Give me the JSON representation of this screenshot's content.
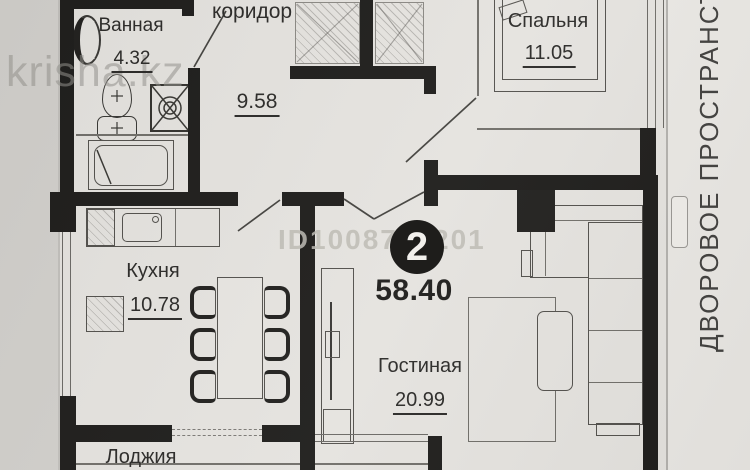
{
  "watermarks": {
    "site": "krisha.kz",
    "listing_id": "ID1008723201"
  },
  "summary": {
    "room_count": "2",
    "total_area": "58.40"
  },
  "rooms": {
    "bathroom": {
      "name": "Ванная",
      "area": "4.32"
    },
    "corridor": {
      "name": "коридор",
      "area": "9.58"
    },
    "bedroom": {
      "name": "Спальня",
      "area": "11.05"
    },
    "kitchen": {
      "name": "Кухня",
      "area": "10.78"
    },
    "living_room": {
      "name": "Гостиная",
      "area": "20.99"
    },
    "loggia": {
      "name": "Лоджия"
    }
  },
  "side_label": "ДВОРОВОЕ ПРОСТРАНСТВО",
  "colors": {
    "paper": "#e5e3df",
    "margin_left": "#d2d0cc",
    "margin_right": "#eae8e4",
    "wall": "#201f1d",
    "badge": "#171614",
    "text": "#2d2c2a",
    "watermark": "#a8a6a0"
  }
}
